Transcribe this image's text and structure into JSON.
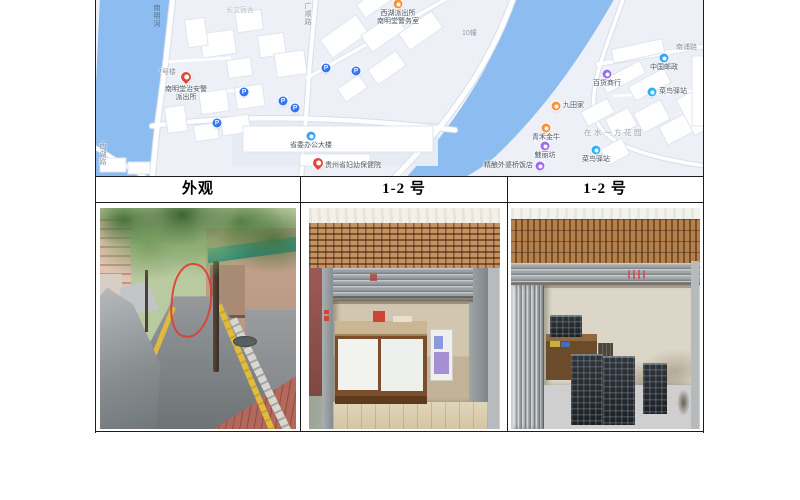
{
  "table": {
    "headers": [
      "外观",
      "1-2 号",
      "1-2 号"
    ]
  },
  "map": {
    "colors": {
      "background": "#edf1f7",
      "water": "#8cbcf0",
      "road": "#ffffff",
      "building": "#ffffff",
      "parking_blue": "#3577f2",
      "pin_red": "#e2463a",
      "poi_orange": "#f5923c",
      "poi_purple": "#9a6cf0",
      "poi_cyan": "#2fb1f2",
      "poi_blue": "#3aa3f0"
    },
    "road_labels": [
      {
        "id": "nanming-river",
        "text": "南明河",
        "x": 56,
        "y": 4,
        "vertical": true,
        "style": "river"
      },
      {
        "id": "guangshun-road",
        "text": "广顺路",
        "x": 207,
        "y": 2,
        "vertical": true,
        "style": "road"
      },
      {
        "id": "xihu-road",
        "text": "西湖路",
        "x": 2,
        "y": 142,
        "vertical": true,
        "style": "road"
      },
      {
        "id": "nanpu-road",
        "text": "南浦路",
        "x": 580,
        "y": 44,
        "vertical": false,
        "style": "road"
      },
      {
        "id": "building-7",
        "text": "7号楼",
        "x": 62,
        "y": 69,
        "vertical": false,
        "style": "road"
      },
      {
        "id": "building-10",
        "text": "10幢",
        "x": 366,
        "y": 30,
        "vertical": false,
        "style": "road"
      },
      {
        "id": "dormitory-area",
        "text": "长文宿舍",
        "x": 130,
        "y": 7,
        "vertical": false,
        "style": "faint"
      },
      {
        "id": "zaishuiyifang-garden",
        "text": "在水一方花园",
        "x": 488,
        "y": 129,
        "vertical": false,
        "style": "area"
      }
    ],
    "pois": [
      {
        "id": "nanmingtang-police",
        "kind": "pin-red",
        "x": 90,
        "y": 80,
        "lines": [
          "南明堂治安警",
          "派出所"
        ],
        "pos": "below"
      },
      {
        "id": "xihu-police",
        "kind": "dot-orange",
        "x": 302,
        "y": 4,
        "lines": [
          "西湖派出所",
          "南明堂警务室"
        ],
        "pos": "below"
      },
      {
        "id": "provincial-office",
        "kind": "dot-blue",
        "x": 215,
        "y": 136,
        "lines": [
          "省委办公大楼"
        ],
        "pos": "below"
      },
      {
        "id": "maternity-hospital",
        "kind": "pin-red",
        "x": 222,
        "y": 166,
        "lines": [
          "贵州省妇幼保健院"
        ],
        "pos": "right"
      },
      {
        "id": "china-post",
        "kind": "dot-blue",
        "x": 568,
        "y": 58,
        "lines": [
          "中国邮政"
        ],
        "pos": "below"
      },
      {
        "id": "baihuo-shop",
        "kind": "dot-purple",
        "x": 511,
        "y": 74,
        "lines": [
          "百货商行"
        ],
        "pos": "below"
      },
      {
        "id": "cainiao-station-1",
        "kind": "dot-cyan",
        "x": 556,
        "y": 92,
        "lines": [
          "菜鸟驿站"
        ],
        "pos": "right"
      },
      {
        "id": "jiutianjia",
        "kind": "dot-orange",
        "x": 460,
        "y": 106,
        "lines": [
          "九田家"
        ],
        "pos": "right"
      },
      {
        "id": "qinghe-jinniu",
        "kind": "dot-orange",
        "x": 450,
        "y": 128,
        "lines": [
          "青禾金牛"
        ],
        "pos": "below"
      },
      {
        "id": "meilifang",
        "kind": "dot-purple",
        "x": 449,
        "y": 146,
        "lines": [
          "魅丽坊"
        ],
        "pos": "below"
      },
      {
        "id": "cainiao-station-2",
        "kind": "dot-cyan",
        "x": 500,
        "y": 150,
        "lines": [
          "菜鸟驿站"
        ],
        "pos": "below"
      },
      {
        "id": "waipoqiao-restaurant",
        "kind": "dot-purple",
        "x": 444,
        "y": 166,
        "lines": [
          "精酿外婆桥饭店"
        ],
        "pos": "left"
      }
    ],
    "parking_glyph": "P",
    "parking": [
      {
        "x": 148,
        "y": 92
      },
      {
        "x": 187,
        "y": 101
      },
      {
        "x": 199,
        "y": 108
      },
      {
        "x": 230,
        "y": 68
      },
      {
        "x": 260,
        "y": 71
      },
      {
        "x": 121,
        "y": 123
      }
    ]
  }
}
